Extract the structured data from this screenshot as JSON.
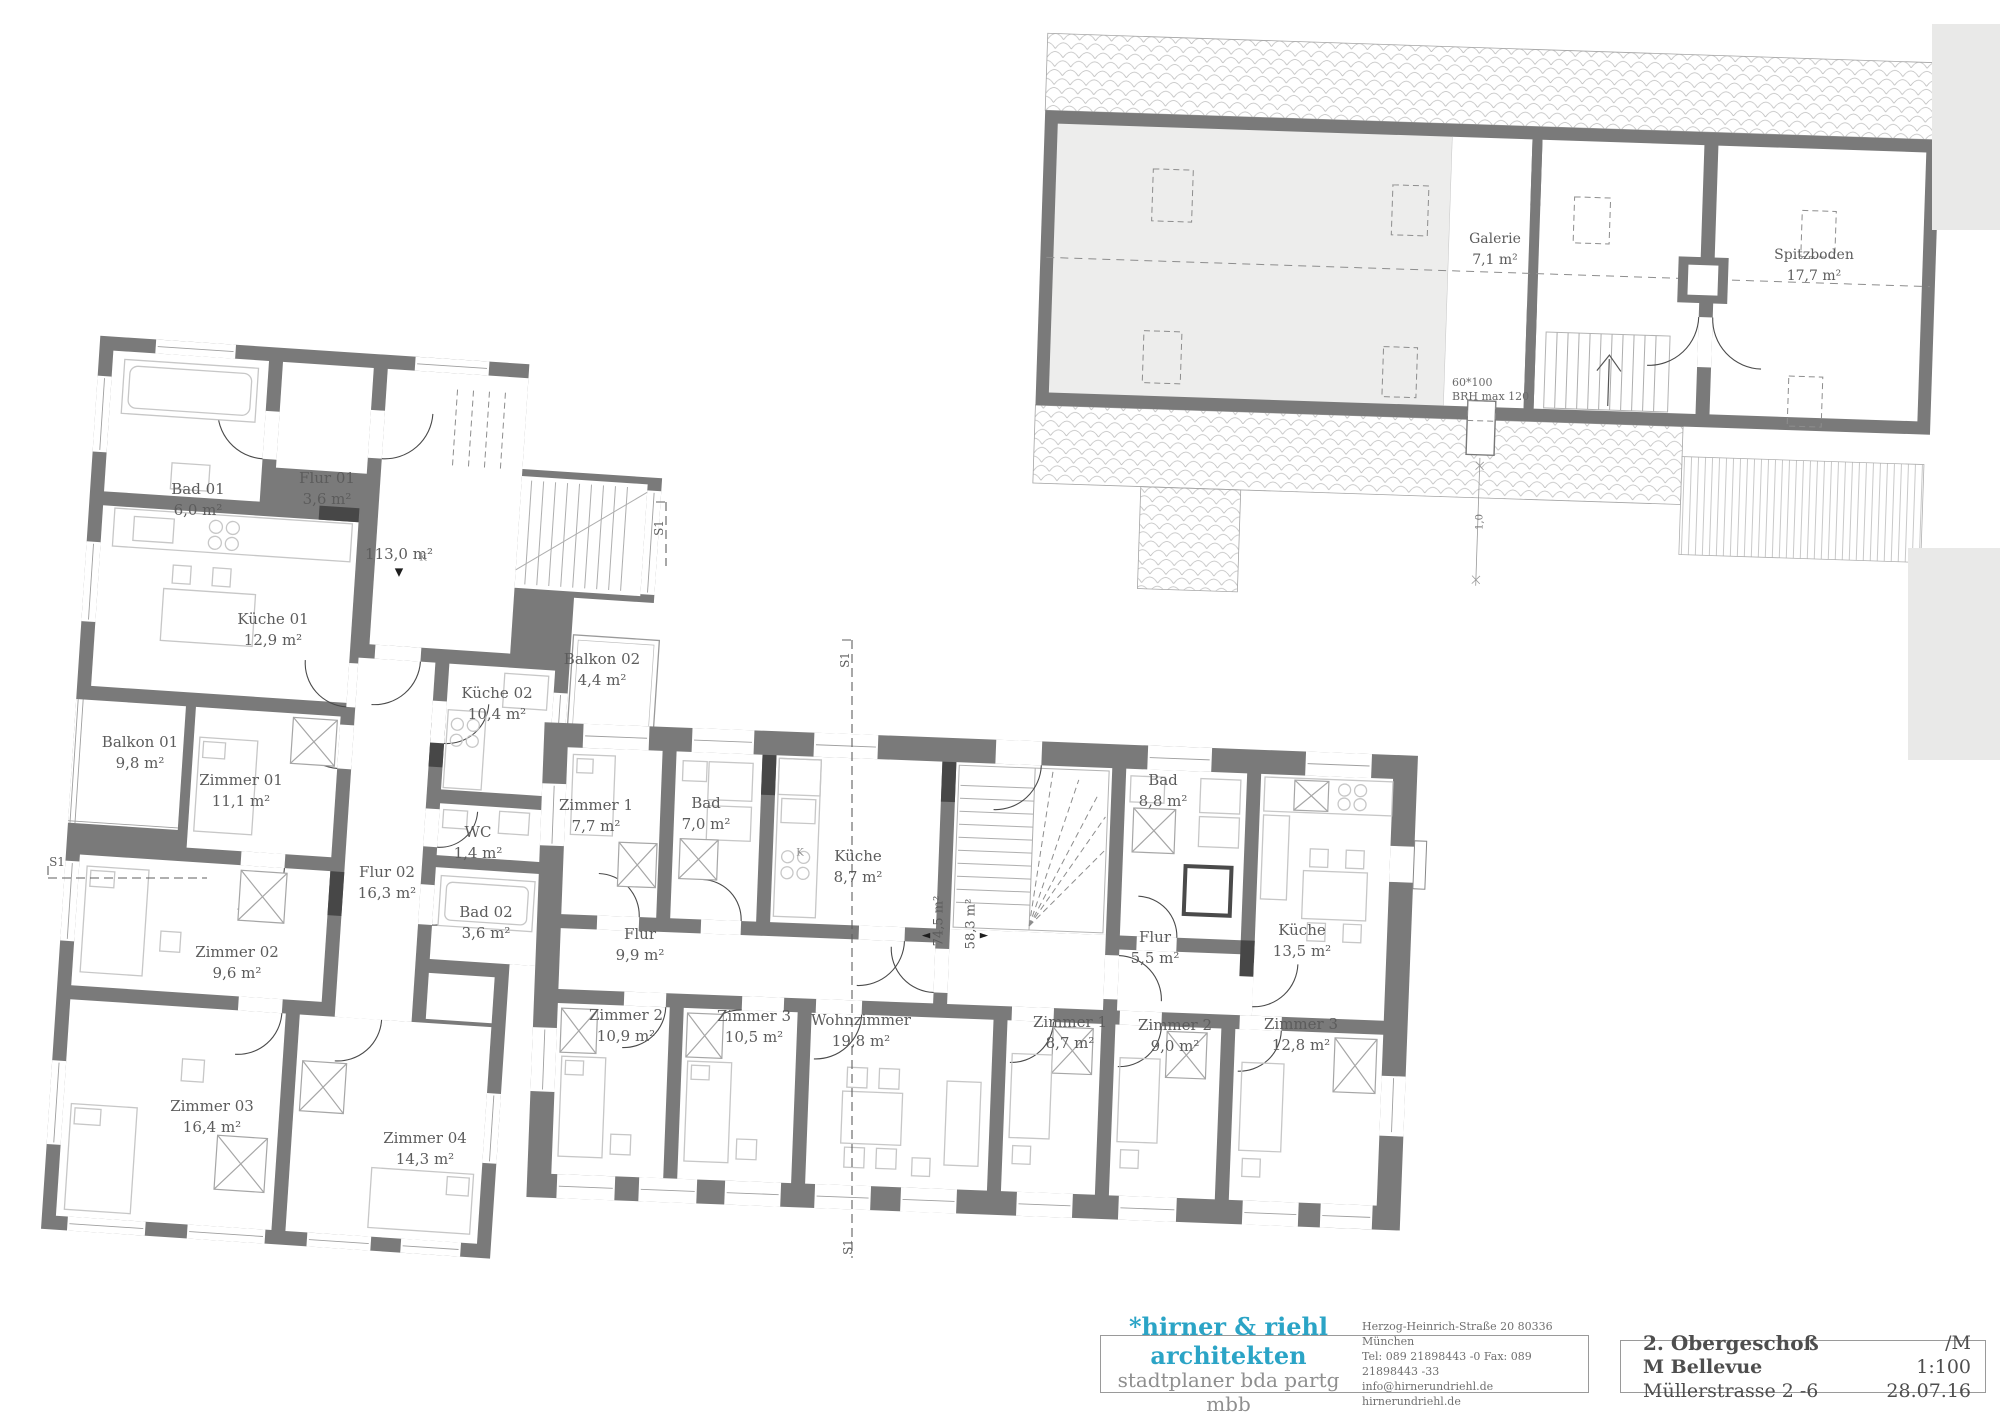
{
  "title_block": {
    "firm": "*hirner & riehl  architekten",
    "firm_sub": "stadtplaner bda  partg mbb",
    "address_line1": "Herzog-Heinrich-Straße 20   80336 München",
    "address_line2": "Tel: 089 21898443 -0    Fax: 089 21898443 -33",
    "address_line3": "info@hirnerundriehl.de        hirnerundriehl.de",
    "floor": "2. Obergeschoß",
    "project_name": "M Bellevue",
    "project_address": "Müllerstrasse 2 -6",
    "scale": "/M 1:100",
    "date": "28.07.16"
  },
  "left_building": {
    "total_area": "113,0 m²",
    "rooms": [
      {
        "name": "Bad 01",
        "area": "6,0 m²"
      },
      {
        "name": "Flur 01",
        "area": "3,6 m²"
      },
      {
        "name": "Küche 01",
        "area": "12,9 m²"
      },
      {
        "name": "Küche 02",
        "area": "10,4 m²"
      },
      {
        "name": "Balkon 02",
        "area": "4,4 m²"
      },
      {
        "name": "Balkon 01",
        "area": "9,8 m²"
      },
      {
        "name": "Zimmer 01",
        "area": "11,1 m²"
      },
      {
        "name": "WC",
        "area": "1,4 m²"
      },
      {
        "name": "Flur 02",
        "area": "16,3 m²"
      },
      {
        "name": "Bad 02",
        "area": "3,6 m²"
      },
      {
        "name": "Zimmer 02",
        "area": "9,6 m²"
      },
      {
        "name": "Zimmer 03",
        "area": "16,4 m²"
      },
      {
        "name": "Zimmer 04",
        "area": "14,3 m²"
      }
    ]
  },
  "middle_building": {
    "apartment_left": {
      "total_area": "74,5 m²",
      "rooms": [
        {
          "name": "Zimmer 1",
          "area": "7,7 m²"
        },
        {
          "name": "Bad",
          "area": "7,0 m²"
        },
        {
          "name": "Küche",
          "area": "8,7 m²"
        },
        {
          "name": "Flur",
          "area": "9,9 m²"
        },
        {
          "name": "Zimmer 2",
          "area": "10,9 m²"
        },
        {
          "name": "Zimmer 3",
          "area": "10,5 m²"
        },
        {
          "name": "Wohnzimmer",
          "area": "19,8 m²"
        }
      ]
    },
    "apartment_right": {
      "total_area": "58,3 m²",
      "rooms": [
        {
          "name": "Bad",
          "area": "8,8 m²"
        },
        {
          "name": "Flur",
          "area": "5,5 m²"
        },
        {
          "name": "Küche",
          "area": "13,5 m²"
        },
        {
          "name": "Zimmer 1",
          "area": "8,7 m²"
        },
        {
          "name": "Zimmer 2",
          "area": "9,0 m²"
        },
        {
          "name": "Zimmer 3",
          "area": "12,8 m²"
        }
      ]
    }
  },
  "attic": {
    "rooms": [
      {
        "name": "Galerie",
        "area": "7,1 m²"
      },
      {
        "name": "Spitzboden",
        "area": "17,7 m²"
      }
    ],
    "window_note": {
      "line1": "60*100",
      "line2": "BRH max 120"
    },
    "dim": "1,0"
  },
  "sections": {
    "label": "S1"
  },
  "markers": {
    "down": "▼",
    "left": "◄",
    "right": "►",
    "kitchen": "K"
  }
}
